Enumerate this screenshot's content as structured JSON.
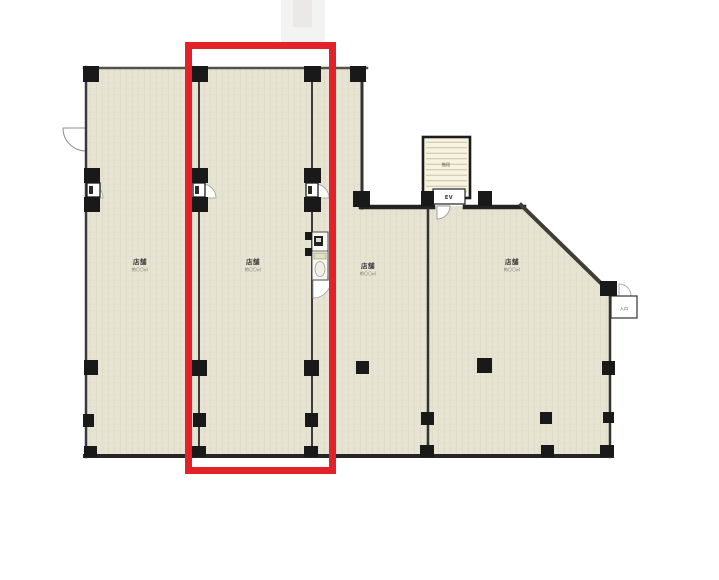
{
  "plan": {
    "type": "floor-plan-scan",
    "units": [
      {
        "name": "店舗",
        "area": "約〇〇㎡",
        "highlighted": false
      },
      {
        "name": "店舗",
        "area": "約〇〇㎡",
        "highlighted": true
      },
      {
        "name": "店舗",
        "area": "約〇〇㎡",
        "highlighted": false
      },
      {
        "name": "店舗",
        "area": "約〇〇㎡",
        "highlighted": false
      }
    ],
    "stairwell": {
      "label": "階段"
    },
    "elevator": {
      "label": "EV"
    },
    "entrance": {
      "label": "入口"
    },
    "colors": {
      "highlight": "#e32128",
      "floor": "#e7e3d3",
      "wall": "#3c3c3c",
      "column": "#191919",
      "stair_fill": "#f7f3e1",
      "stair_hatch": "#c9c1a3"
    }
  }
}
